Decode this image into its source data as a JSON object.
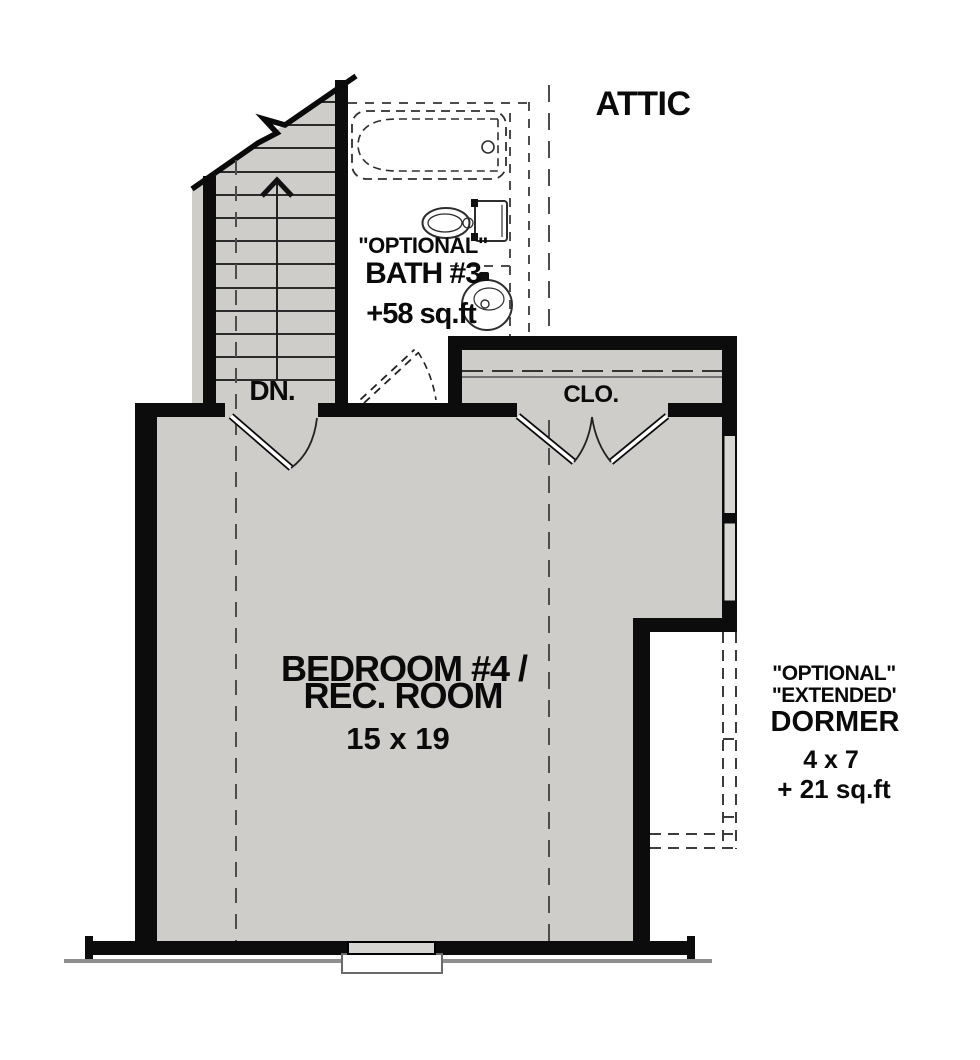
{
  "plan_labels": {
    "attic": "ATTIC",
    "stairs_direction": "DN.",
    "bath": {
      "qualifier": "\"OPTIONAL\"",
      "name": "BATH #3",
      "area": "+58 sq.ft"
    },
    "closet": "CLO.",
    "bedroom": {
      "line1": "BEDROOM #4 /",
      "line2": "REC. ROOM",
      "dimensions": "15 x 19"
    },
    "dormer": {
      "qualifier_line1": "\"OPTIONAL\"",
      "qualifier_line2": "\"EXTENDED'",
      "name": "DORMER",
      "dimensions": "4 x 7",
      "area": "+ 21 sq.ft"
    }
  },
  "colors": {
    "wall": "#0c0c0c",
    "floor": "#cfcdc9",
    "window_glass": "#d9d7d3",
    "dashed_line": "#4d4d4d",
    "foundation_line": "#8f8f8f",
    "fixture_line": "#2e2e2e",
    "text": "#0a0a0a"
  }
}
